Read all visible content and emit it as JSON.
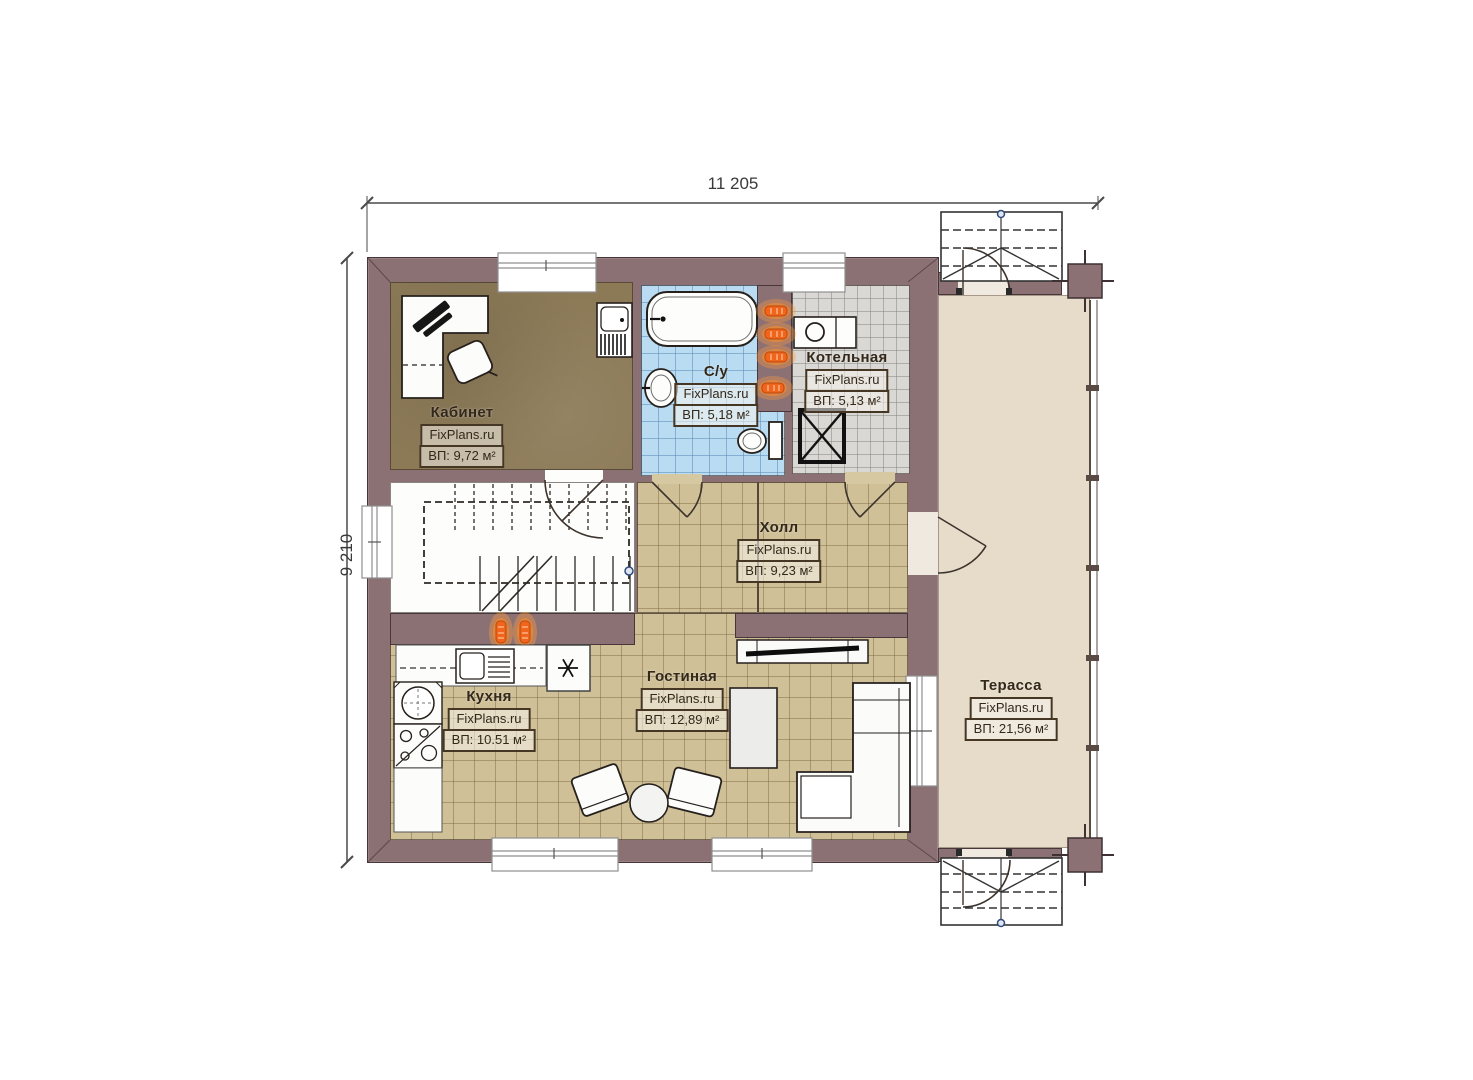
{
  "plan_title": "floor-plan",
  "dimensions": {
    "width": "11 205",
    "height": "9 210"
  },
  "brand": "FixPlans.ru",
  "rooms": {
    "office": {
      "name": "Кабинет",
      "brand": "FixPlans.ru",
      "area": "ВП: 9,72 м²"
    },
    "bathroom": {
      "name": "С/у",
      "brand": "FixPlans.ru",
      "area": "ВП: 5,18 м²"
    },
    "boiler": {
      "name": "Котельная",
      "brand": "FixPlans.ru",
      "area": "ВП: 5,13 м²"
    },
    "hall": {
      "name": "Холл",
      "brand": "FixPlans.ru",
      "area": "ВП: 9,23 м²"
    },
    "kitchen": {
      "name": "Кухня",
      "brand": "FixPlans.ru",
      "area": "ВП: 10.51 м²"
    },
    "living": {
      "name": "Гостиная",
      "brand": "FixPlans.ru",
      "area": "ВП: 12,89 м²"
    },
    "terrace": {
      "name": "Терасса",
      "brand": "FixPlans.ru",
      "area": "ВП: 21,56 м²"
    }
  },
  "colors": {
    "wall": "#8b7173",
    "office_floor": "#8c7a57",
    "tile_tan": "#cfc098",
    "tile_blue": "#badcf2",
    "tile_gray": "#d9d8d4",
    "terrace_floor": "#e6dcc9",
    "radiator": "#f2641c"
  }
}
